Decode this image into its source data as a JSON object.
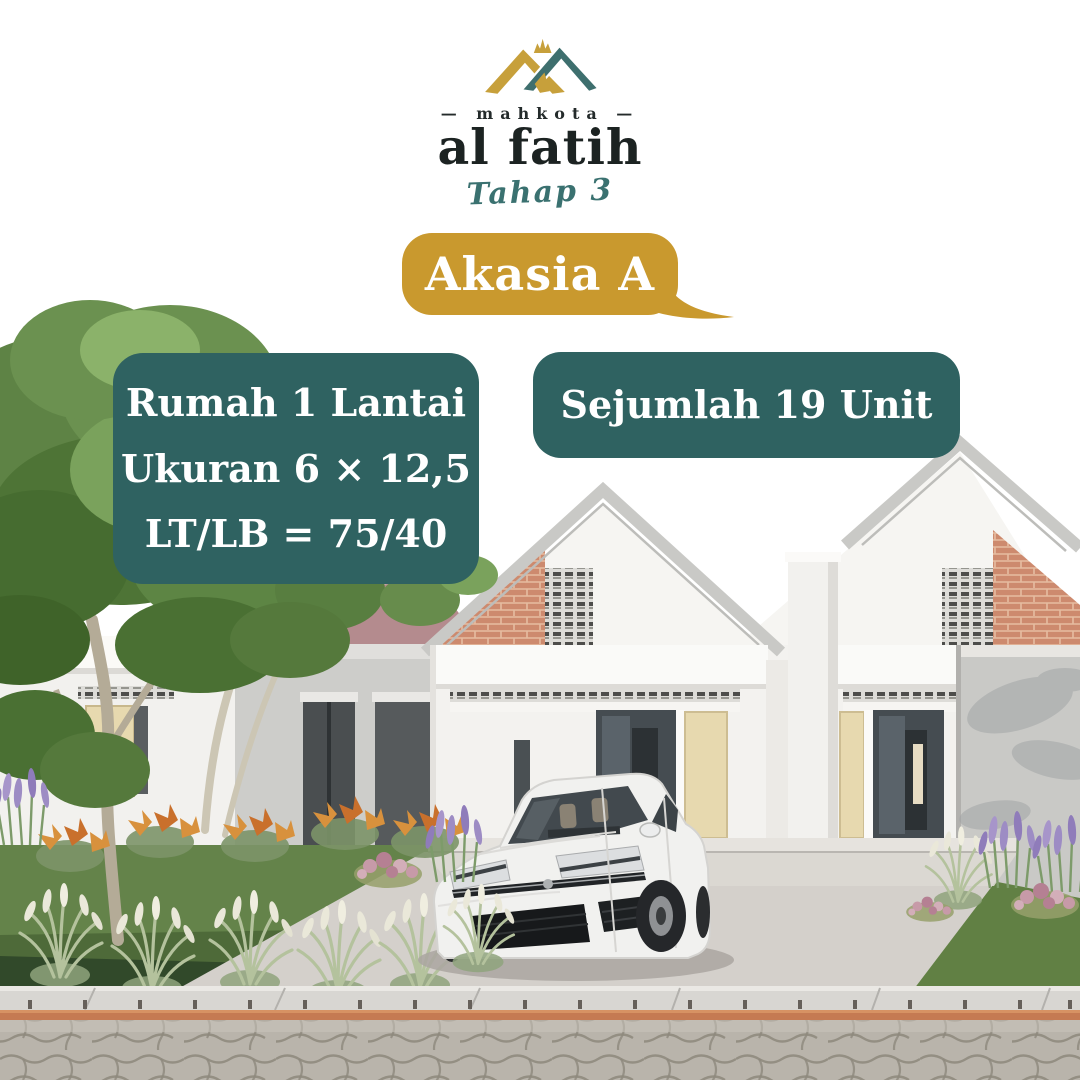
{
  "logo": {
    "brand_top": "— mahkota —",
    "brand_main": "al fatih",
    "phase": "Tahap 3"
  },
  "badge": {
    "label": "Akasia A"
  },
  "info_left": {
    "lines": [
      "Rumah 1 Lantai",
      "Ukuran 6 × 12,5",
      "LT/LB = 75/40"
    ]
  },
  "info_right": {
    "label": "Sejumlah 19 Unit"
  },
  "colors": {
    "teal": "#2f6261",
    "gold": "#c9992e",
    "logo_gold": "#c7a03b",
    "logo_teal": "#3e6f6e",
    "script_teal": "#3a7170",
    "ink": "#242b2b"
  }
}
